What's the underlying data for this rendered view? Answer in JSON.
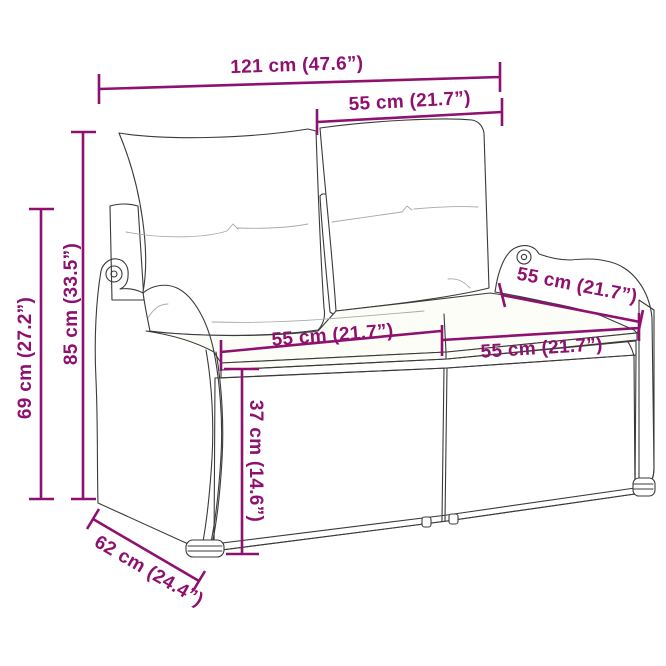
{
  "figure": {
    "title": "Garden bench dimension diagram",
    "product": "Poly rattan 2-seater garden bench with cushions",
    "accent_color": "#8e1170",
    "line_color": "#3a3a3a",
    "background_color": "#ffffff"
  },
  "measurements": {
    "overall_width": "121 cm (47.6”)",
    "backrest_width": "55 cm (21.7”)",
    "overall_height": "85 cm (33.5”)",
    "armrest_height": "69 cm (27.2”)",
    "seat_width_left": "55 cm (21.7”)",
    "seat_width_right": "55 cm (21.7”)",
    "armrest_depth": "55 cm (21.7”)",
    "seat_height": "37 cm (14.6”)",
    "overall_depth": "62 cm (24.4”)"
  }
}
